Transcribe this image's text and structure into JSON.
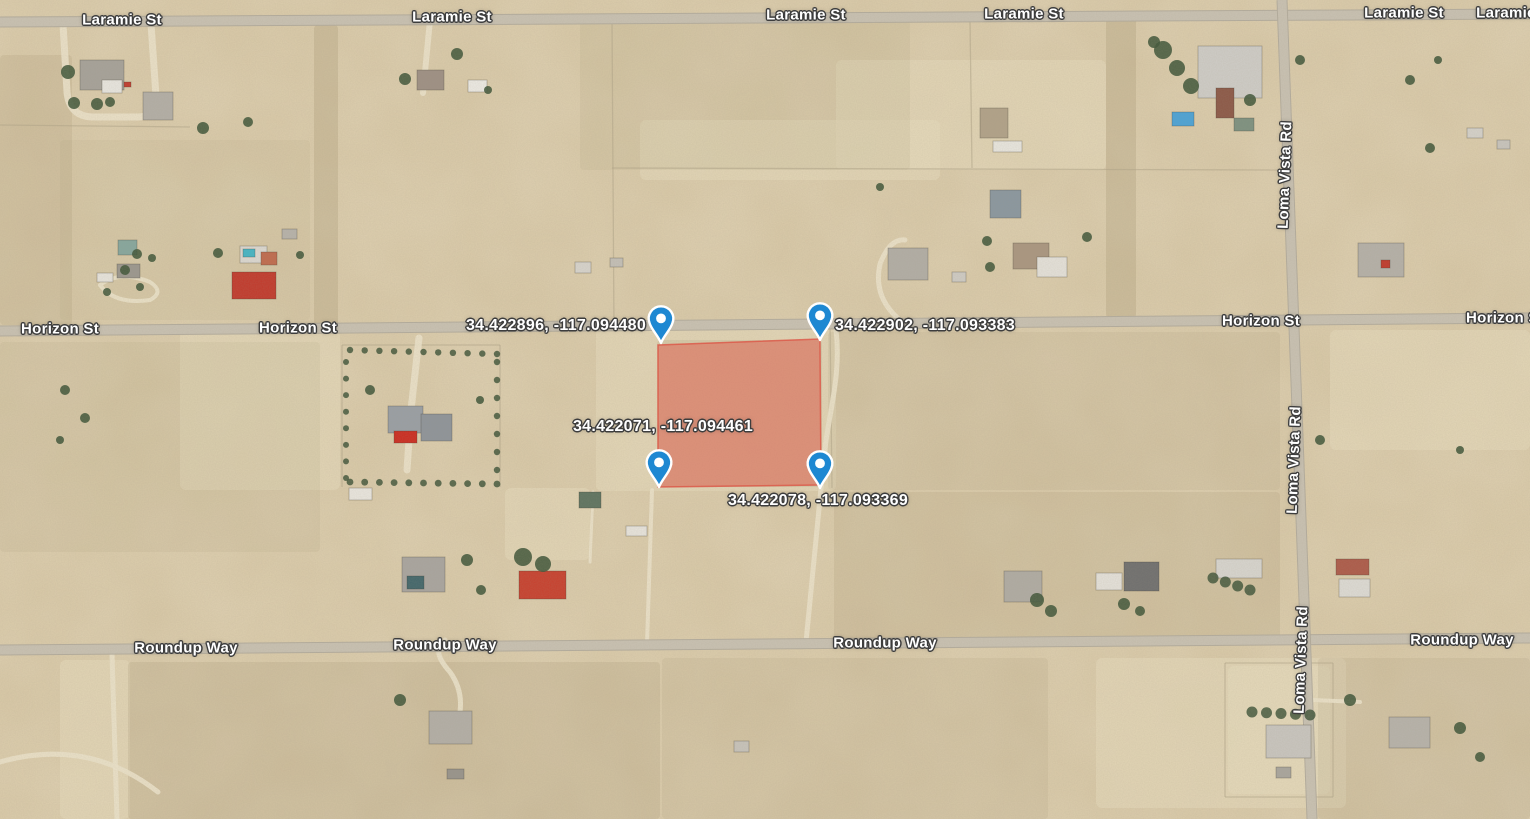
{
  "map": {
    "width": 1530,
    "height": 819,
    "colors": {
      "desert_base": "#d8c8a6",
      "desert_light": "#e8dcbe",
      "desert_scrub": "#9c8c6a",
      "road_paved": "#c9c2b3",
      "road_edge": "#b4ad9e",
      "dirt_track": "#ecE3cb",
      "lot_line": "#b2a68a",
      "parcel_fill": "rgba(229,72,60,0.42)",
      "parcel_stroke": "rgba(220,80,66,0.75)",
      "pin_fill": "#1e88d2",
      "pin_outline": "#ffffff",
      "tree": "#3f5539",
      "label_text": "#ffffff",
      "label_halo": "#3d3d3d"
    },
    "roads": [
      {
        "name": "Laramie St",
        "x1": 0,
        "y1": 22,
        "x2": 1530,
        "y2": 14,
        "w": 9
      },
      {
        "name": "Horizon St",
        "x1": 0,
        "y1": 331,
        "x2": 1530,
        "y2": 318,
        "w": 9
      },
      {
        "name": "Roundup Way",
        "x1": 0,
        "y1": 650,
        "x2": 1530,
        "y2": 638,
        "w": 9
      },
      {
        "name": "Loma Vista Rd",
        "x1": 1282,
        "y1": 0,
        "x2": 1312,
        "y2": 819,
        "w": 9
      }
    ],
    "road_labels": [
      {
        "text": "Laramie St",
        "x": 122,
        "y": 20,
        "vertical": false
      },
      {
        "text": "Laramie St",
        "x": 452,
        "y": 17,
        "vertical": false
      },
      {
        "text": "Laramie St",
        "x": 806,
        "y": 15,
        "vertical": false
      },
      {
        "text": "Laramie St",
        "x": 1024,
        "y": 14,
        "vertical": false
      },
      {
        "text": "Laramie St",
        "x": 1404,
        "y": 13,
        "vertical": false
      },
      {
        "text": "Laramie St",
        "x": 1516,
        "y": 13,
        "vertical": false
      },
      {
        "text": "Horizon St",
        "x": 60,
        "y": 329,
        "vertical": false
      },
      {
        "text": "Horizon St",
        "x": 298,
        "y": 328,
        "vertical": false
      },
      {
        "text": "Horizon St",
        "x": 1261,
        "y": 321,
        "vertical": false
      },
      {
        "text": "Horizon St",
        "x": 1505,
        "y": 318,
        "vertical": false
      },
      {
        "text": "Roundup Way",
        "x": 186,
        "y": 648,
        "vertical": false
      },
      {
        "text": "Roundup Way",
        "x": 445,
        "y": 645,
        "vertical": false
      },
      {
        "text": "Roundup Way",
        "x": 885,
        "y": 643,
        "vertical": false
      },
      {
        "text": "Roundup Way",
        "x": 1462,
        "y": 640,
        "vertical": false
      },
      {
        "text": "Loma Vista Rd",
        "x": 1285,
        "y": 175,
        "vertical": true
      },
      {
        "text": "Loma Vista Rd",
        "x": 1294,
        "y": 460,
        "vertical": true
      },
      {
        "text": "Loma Vista Rd",
        "x": 1301,
        "y": 660,
        "vertical": true
      }
    ],
    "coordinate_labels": [
      {
        "text": "34.422896, -117.094480",
        "x": 556,
        "y": 326
      },
      {
        "text": "34.422902, -117.093383",
        "x": 925,
        "y": 326
      },
      {
        "text": "34.422071, -117.094461",
        "x": 663,
        "y": 427
      },
      {
        "text": "34.422078, -117.093369",
        "x": 818,
        "y": 501
      }
    ],
    "pins": [
      {
        "x": 661,
        "y": 343
      },
      {
        "x": 820,
        "y": 340
      },
      {
        "x": 659,
        "y": 487
      },
      {
        "x": 820,
        "y": 488
      }
    ],
    "parcel": {
      "points": "658,345 820,339 821,485 658,487"
    },
    "lot_lines": [
      [
        612,
        22,
        614,
        330
      ],
      [
        970,
        20,
        972,
        168
      ],
      [
        612,
        168,
        1281,
        170
      ],
      [
        342,
        345,
        500,
        345
      ],
      [
        342,
        345,
        342,
        487
      ],
      [
        500,
        345,
        500,
        487
      ],
      [
        830,
        322,
        832,
        488
      ],
      [
        1225,
        663,
        1333,
        663
      ],
      [
        1225,
        663,
        1225,
        797
      ],
      [
        1333,
        663,
        1333,
        797
      ],
      [
        1225,
        797,
        1333,
        797
      ],
      [
        0,
        125,
        190,
        127
      ]
    ],
    "dirt_tracks": [
      {
        "d": "M63,24 L67,92 Q69,116 92,117 L138,117 Q157,117 156,96 L151,24",
        "w": 7
      },
      {
        "d": "M430,20 L423,93",
        "w": 6
      },
      {
        "d": "M419,338 L411,410 L407,470",
        "w": 7
      },
      {
        "d": "M836,330 C842,380 826,420 823,468 L806,642",
        "w": 5
      },
      {
        "d": "M652,490 L647,644",
        "w": 4
      },
      {
        "d": "M593,492 L590,562",
        "w": 3
      },
      {
        "d": "M112,654 L117,819",
        "w": 5
      },
      {
        "d": "M0,762 Q88,737 158,792",
        "w": 5
      },
      {
        "d": "M905,324 Q872,300 880,264 Q890,238 905,240",
        "w": 5
      },
      {
        "d": "M100,285 Q120,270 150,282 Q165,292 150,300 Q115,305 100,285",
        "w": 4
      },
      {
        "d": "M452,737 Q470,700 450,672 Q430,650 445,640",
        "w": 5
      },
      {
        "d": "M1312,700 L1360,702",
        "w": 4
      }
    ],
    "light_patches": [
      {
        "x": 596,
        "y": 326,
        "w": 240,
        "h": 165
      },
      {
        "x": 1096,
        "y": 658,
        "w": 250,
        "h": 150
      },
      {
        "x": 836,
        "y": 60,
        "w": 270,
        "h": 110
      },
      {
        "x": 180,
        "y": 330,
        "w": 160,
        "h": 160
      },
      {
        "x": 1330,
        "y": 330,
        "w": 200,
        "h": 120
      },
      {
        "x": 60,
        "y": 660,
        "w": 70,
        "h": 159
      },
      {
        "x": 505,
        "y": 488,
        "w": 85,
        "h": 72
      },
      {
        "x": 640,
        "y": 120,
        "w": 300,
        "h": 60
      },
      {
        "x": 1228,
        "y": 666,
        "w": 102,
        "h": 128
      }
    ],
    "scrub_patches": [
      {
        "x": 0,
        "y": 55,
        "w": 72,
        "h": 270,
        "o": 0.3
      },
      {
        "x": 314,
        "y": 25,
        "w": 24,
        "h": 302,
        "o": 0.45
      },
      {
        "x": 1106,
        "y": 18,
        "w": 30,
        "h": 300,
        "o": 0.45
      },
      {
        "x": 828,
        "y": 332,
        "w": 452,
        "h": 158,
        "o": 0.22
      },
      {
        "x": 834,
        "y": 492,
        "w": 446,
        "h": 148,
        "o": 0.3
      },
      {
        "x": 128,
        "y": 662,
        "w": 532,
        "h": 157,
        "o": 0.33
      },
      {
        "x": 662,
        "y": 658,
        "w": 386,
        "h": 161,
        "o": 0.22
      },
      {
        "x": 0,
        "y": 342,
        "w": 320,
        "h": 210,
        "o": 0.18
      },
      {
        "x": 1318,
        "y": 658,
        "w": 212,
        "h": 161,
        "o": 0.25
      },
      {
        "x": 657,
        "y": 340,
        "w": 165,
        "h": 147,
        "o": 0.3
      },
      {
        "x": 580,
        "y": 20,
        "w": 330,
        "h": 150,
        "o": 0.18
      },
      {
        "x": 60,
        "y": 140,
        "w": 250,
        "h": 180,
        "o": 0.15
      }
    ],
    "houses": [
      {
        "x": 80,
        "y": 60,
        "w": 44,
        "h": 30,
        "c": "#a6a29a"
      },
      {
        "x": 102,
        "y": 80,
        "w": 20,
        "h": 13,
        "c": "#e9e7e1"
      },
      {
        "x": 124,
        "y": 82,
        "w": 7,
        "h": 5,
        "c": "#c23b2e"
      },
      {
        "x": 143,
        "y": 92,
        "w": 30,
        "h": 28,
        "c": "#b3afa7"
      },
      {
        "x": 417,
        "y": 70,
        "w": 27,
        "h": 20,
        "c": "#9e9084"
      },
      {
        "x": 468,
        "y": 80,
        "w": 19,
        "h": 12,
        "c": "#edebe5"
      },
      {
        "x": 980,
        "y": 108,
        "w": 28,
        "h": 30,
        "c": "#b1a289"
      },
      {
        "x": 993,
        "y": 141,
        "w": 29,
        "h": 11,
        "c": "#e9e7e0"
      },
      {
        "x": 1198,
        "y": 46,
        "w": 64,
        "h": 52,
        "c": "#cfcdc8"
      },
      {
        "x": 1216,
        "y": 88,
        "w": 18,
        "h": 30,
        "c": "#8c5847"
      },
      {
        "x": 1172,
        "y": 112,
        "w": 22,
        "h": 14,
        "c": "#4aa3d8"
      },
      {
        "x": 1234,
        "y": 118,
        "w": 20,
        "h": 13,
        "c": "#7d9180"
      },
      {
        "x": 888,
        "y": 248,
        "w": 40,
        "h": 32,
        "c": "#b2aea6"
      },
      {
        "x": 990,
        "y": 190,
        "w": 31,
        "h": 28,
        "c": "#8a97a0"
      },
      {
        "x": 1013,
        "y": 243,
        "w": 36,
        "h": 26,
        "c": "#aa9680"
      },
      {
        "x": 1037,
        "y": 257,
        "w": 30,
        "h": 20,
        "c": "#e5e2db"
      },
      {
        "x": 1358,
        "y": 243,
        "w": 46,
        "h": 34,
        "c": "#b5b1a9"
      },
      {
        "x": 1381,
        "y": 260,
        "w": 9,
        "h": 8,
        "c": "#c0392b"
      },
      {
        "x": 118,
        "y": 240,
        "w": 19,
        "h": 15,
        "c": "#86a79e"
      },
      {
        "x": 117,
        "y": 264,
        "w": 23,
        "h": 14,
        "c": "#9b978f"
      },
      {
        "x": 97,
        "y": 273,
        "w": 16,
        "h": 9,
        "c": "#e8e5de"
      },
      {
        "x": 240,
        "y": 246,
        "w": 27,
        "h": 17,
        "c": "#dcd9d2"
      },
      {
        "x": 243,
        "y": 249,
        "w": 12,
        "h": 8,
        "c": "#43b5c6"
      },
      {
        "x": 261,
        "y": 252,
        "w": 16,
        "h": 13,
        "c": "#c06a4d"
      },
      {
        "x": 232,
        "y": 272,
        "w": 44,
        "h": 27,
        "c": "#c2392c"
      },
      {
        "x": 388,
        "y": 406,
        "w": 35,
        "h": 27,
        "c": "#999fa5"
      },
      {
        "x": 421,
        "y": 414,
        "w": 31,
        "h": 27,
        "c": "#8e949a"
      },
      {
        "x": 394,
        "y": 431,
        "w": 23,
        "h": 12,
        "c": "#cc2b20"
      },
      {
        "x": 349,
        "y": 488,
        "w": 23,
        "h": 12,
        "c": "#eae7e0"
      },
      {
        "x": 579,
        "y": 492,
        "w": 22,
        "h": 16,
        "c": "#5d7360"
      },
      {
        "x": 402,
        "y": 557,
        "w": 43,
        "h": 35,
        "c": "#a9a5a0"
      },
      {
        "x": 407,
        "y": 576,
        "w": 17,
        "h": 13,
        "c": "#41666b"
      },
      {
        "x": 519,
        "y": 571,
        "w": 47,
        "h": 28,
        "c": "#c8402e"
      },
      {
        "x": 626,
        "y": 526,
        "w": 21,
        "h": 10,
        "c": "#e8e5de"
      },
      {
        "x": 1004,
        "y": 571,
        "w": 38,
        "h": 31,
        "c": "#b0aca4"
      },
      {
        "x": 1096,
        "y": 573,
        "w": 26,
        "h": 17,
        "c": "#e5e2db"
      },
      {
        "x": 1124,
        "y": 562,
        "w": 35,
        "h": 29,
        "c": "#6f6f6f"
      },
      {
        "x": 1216,
        "y": 559,
        "w": 46,
        "h": 19,
        "c": "#d8d6d0"
      },
      {
        "x": 1336,
        "y": 559,
        "w": 33,
        "h": 16,
        "c": "#ad5a49"
      },
      {
        "x": 1339,
        "y": 579,
        "w": 31,
        "h": 18,
        "c": "#dedcd6"
      },
      {
        "x": 1266,
        "y": 725,
        "w": 45,
        "h": 33,
        "c": "#c9c6c0"
      },
      {
        "x": 1276,
        "y": 767,
        "w": 15,
        "h": 11,
        "c": "#a9a69e"
      },
      {
        "x": 429,
        "y": 711,
        "w": 43,
        "h": 33,
        "c": "#b3afa7"
      },
      {
        "x": 447,
        "y": 769,
        "w": 17,
        "h": 10,
        "c": "#98948c"
      },
      {
        "x": 734,
        "y": 741,
        "w": 15,
        "h": 11,
        "c": "#c8c4bc"
      },
      {
        "x": 1389,
        "y": 717,
        "w": 41,
        "h": 31,
        "c": "#b7b3ab"
      },
      {
        "x": 282,
        "y": 229,
        "w": 15,
        "h": 10,
        "c": "#b7b3ab"
      },
      {
        "x": 575,
        "y": 262,
        "w": 16,
        "h": 11,
        "c": "#d8d5ce"
      },
      {
        "x": 610,
        "y": 258,
        "w": 13,
        "h": 9,
        "c": "#c4c0b8"
      },
      {
        "x": 952,
        "y": 272,
        "w": 14,
        "h": 10,
        "c": "#cfccc5"
      },
      {
        "x": 1467,
        "y": 128,
        "w": 16,
        "h": 10,
        "c": "#d5d2cb"
      },
      {
        "x": 1497,
        "y": 140,
        "w": 13,
        "h": 9,
        "c": "#c8c5be"
      }
    ],
    "trees": [
      [
        68,
        72,
        7
      ],
      [
        74,
        103,
        6
      ],
      [
        97,
        104,
        6
      ],
      [
        110,
        102,
        5
      ],
      [
        203,
        128,
        6
      ],
      [
        248,
        122,
        5
      ],
      [
        405,
        79,
        6
      ],
      [
        457,
        54,
        6
      ],
      [
        488,
        90,
        4
      ],
      [
        1163,
        50,
        9
      ],
      [
        1177,
        68,
        8
      ],
      [
        1191,
        86,
        8
      ],
      [
        1154,
        42,
        6
      ],
      [
        1250,
        100,
        6
      ],
      [
        1300,
        60,
        5
      ],
      [
        1430,
        148,
        5
      ],
      [
        987,
        241,
        5
      ],
      [
        990,
        267,
        5
      ],
      [
        1087,
        237,
        5
      ],
      [
        880,
        187,
        4
      ],
      [
        523,
        557,
        9
      ],
      [
        543,
        564,
        8
      ],
      [
        467,
        560,
        6
      ],
      [
        481,
        590,
        5
      ],
      [
        1037,
        600,
        7
      ],
      [
        1051,
        611,
        6
      ],
      [
        1124,
        604,
        6
      ],
      [
        1140,
        611,
        5
      ],
      [
        400,
        700,
        6
      ],
      [
        65,
        390,
        5
      ],
      [
        85,
        418,
        5
      ],
      [
        60,
        440,
        4
      ],
      [
        218,
        253,
        5
      ],
      [
        300,
        255,
        4
      ],
      [
        1320,
        440,
        5
      ],
      [
        1460,
        450,
        4
      ],
      [
        1350,
        700,
        6
      ],
      [
        1460,
        728,
        6
      ],
      [
        1480,
        757,
        5
      ],
      [
        137,
        254,
        5
      ],
      [
        152,
        258,
        4
      ],
      [
        125,
        270,
        5
      ],
      [
        140,
        287,
        4
      ],
      [
        107,
        292,
        4
      ],
      [
        370,
        390,
        5
      ],
      [
        480,
        400,
        4
      ],
      [
        1410,
        80,
        5
      ],
      [
        1438,
        60,
        4
      ]
    ],
    "tree_rows": [
      {
        "x1": 350,
        "y1": 350,
        "x2": 497,
        "y2": 354,
        "n": 11,
        "r": 3.2
      },
      {
        "x1": 497,
        "y1": 362,
        "x2": 497,
        "y2": 470,
        "n": 7,
        "r": 3.2
      },
      {
        "x1": 346,
        "y1": 362,
        "x2": 346,
        "y2": 478,
        "n": 8,
        "r": 3.0
      },
      {
        "x1": 350,
        "y1": 482,
        "x2": 497,
        "y2": 484,
        "n": 11,
        "r": 3.4
      },
      {
        "x1": 1252,
        "y1": 712,
        "x2": 1310,
        "y2": 715,
        "n": 5,
        "r": 5.5
      },
      {
        "x1": 1213,
        "y1": 578,
        "x2": 1250,
        "y2": 590,
        "n": 4,
        "r": 5.5
      }
    ]
  }
}
